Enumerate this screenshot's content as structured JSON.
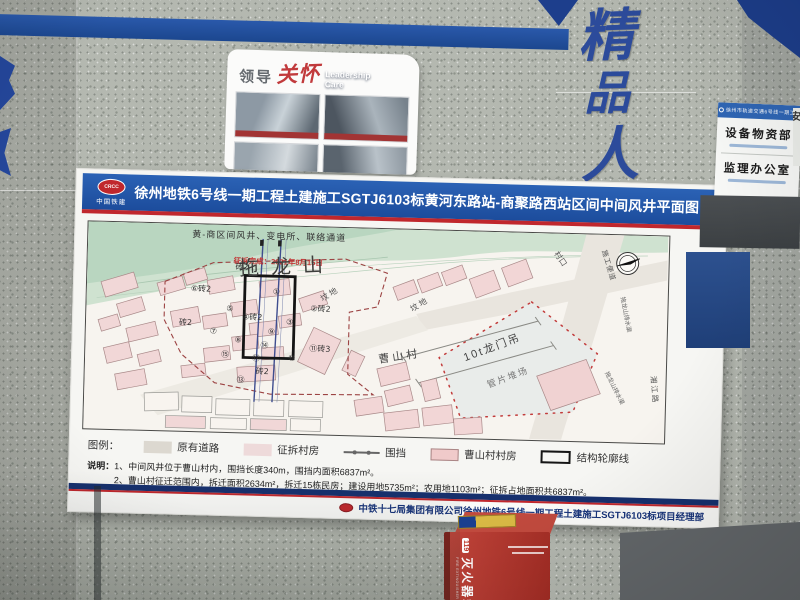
{
  "banner": {
    "org": "中国铁建",
    "org_emblem": "CRCC",
    "title": "徐州地铁6号线一期工程土建施工SGTJ6103标黄河东路站-商聚路西站区间中间风井平面图"
  },
  "map": {
    "top_label": "黄-商区间风井、变电所、联络通道",
    "demolish_note": "征拆完成：2021年8月15日",
    "mountain": "拖龙山",
    "graveyard_1": "坟地",
    "graveyard_2": "坟地",
    "village": "曹山村",
    "village_gate": "村口",
    "construction_road": "施工便道",
    "drainage_1": "拖龙山排水渠",
    "drainage_2": "拖龙山排水渠",
    "road_xiangjiang": "湘江路",
    "gantry_crane": "10t龙门吊",
    "segment_yard": "管片堆场",
    "markers": [
      {
        "t": "①",
        "x": 186,
        "y": 68
      },
      {
        "t": "②砖2",
        "x": 224,
        "y": 84
      },
      {
        "t": "③",
        "x": 200,
        "y": 98
      },
      {
        "t": "④砖2",
        "x": 156,
        "y": 94
      },
      {
        "t": "⑤",
        "x": 140,
        "y": 86
      },
      {
        "t": "⑥砖2",
        "x": 104,
        "y": 67
      },
      {
        "t": "⑦",
        "x": 124,
        "y": 109
      },
      {
        "t": "⑧",
        "x": 149,
        "y": 117
      },
      {
        "t": "⑨",
        "x": 182,
        "y": 108
      },
      {
        "t": "⑩",
        "x": 203,
        "y": 134
      },
      {
        "t": "⑪砖3",
        "x": 224,
        "y": 124
      },
      {
        "t": "⑬",
        "x": 152,
        "y": 157
      },
      {
        "t": "⑭",
        "x": 175,
        "y": 122
      },
      {
        "t": "⑮",
        "x": 136,
        "y": 132
      },
      {
        "t": "⑰",
        "x": 167,
        "y": 135
      },
      {
        "t": "砖2",
        "x": 171,
        "y": 148
      },
      {
        "t": "砖2",
        "x": 148,
        "y": 44
      },
      {
        "t": "砖2",
        "x": 93,
        "y": 101
      }
    ]
  },
  "legend": {
    "title": "图例：",
    "items": [
      {
        "label": "原有道路"
      },
      {
        "label": "征拆村房"
      },
      {
        "label": "围挡"
      },
      {
        "label": "曹山村村房"
      },
      {
        "label": "结构轮廓线"
      }
    ]
  },
  "notes": {
    "label": "说明：",
    "line1": "1、中间风井位于曹山村内，围挡长度340m，围挡内面积6837m²。",
    "line2": "2、曹山村征迁范围内，拆迁面积2634m²，拆迁15栋民房；建设用地5735m²；农用地1103m²；征拆占地面积共6837m²。"
  },
  "footer": {
    "text": "中铁十七局集团有限公司徐州地铁6号线一期工程土建施工SGTJ6103标项目经理部"
  },
  "card": {
    "title_zh_a": "领导",
    "title_zh_b": "关怀",
    "title_en_a": "Leadership",
    "title_en_b": "Care"
  },
  "wall": {
    "chars": [
      "精",
      "品",
      "人"
    ]
  },
  "sign": {
    "header": "徐州市轨道交通6号线一期工程",
    "room_1": "设备物资部",
    "room_2": "监理办公室",
    "partial": "安"
  },
  "fire": {
    "name": "灭火器箱",
    "name_en": "FIRE EXTINGUISHER KIT",
    "hotline": "119"
  }
}
